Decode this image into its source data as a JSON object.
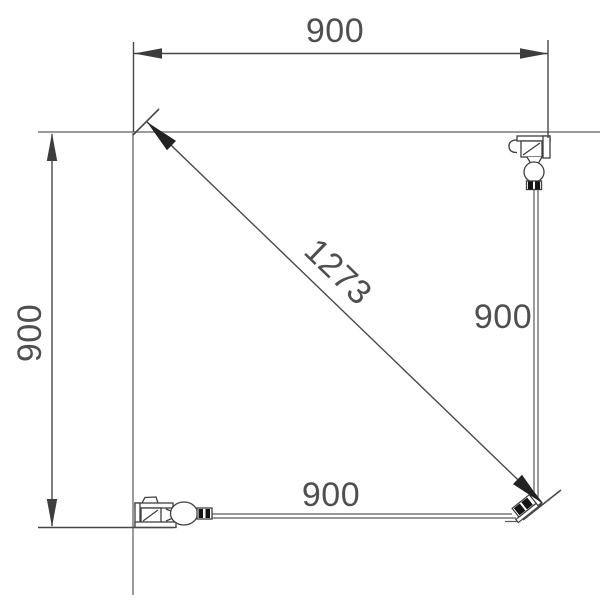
{
  "dims": {
    "top": "900",
    "left": "900",
    "diagonal": "1273",
    "right": "900",
    "bottom": "900"
  },
  "colors": {
    "dimension_line": "#474747",
    "label_text": "#4f4f4f",
    "wall_line": "#9b9b9b",
    "rod_line": "#5a5a5a",
    "clamp_fill": "#141414",
    "background": "#ffffff"
  }
}
